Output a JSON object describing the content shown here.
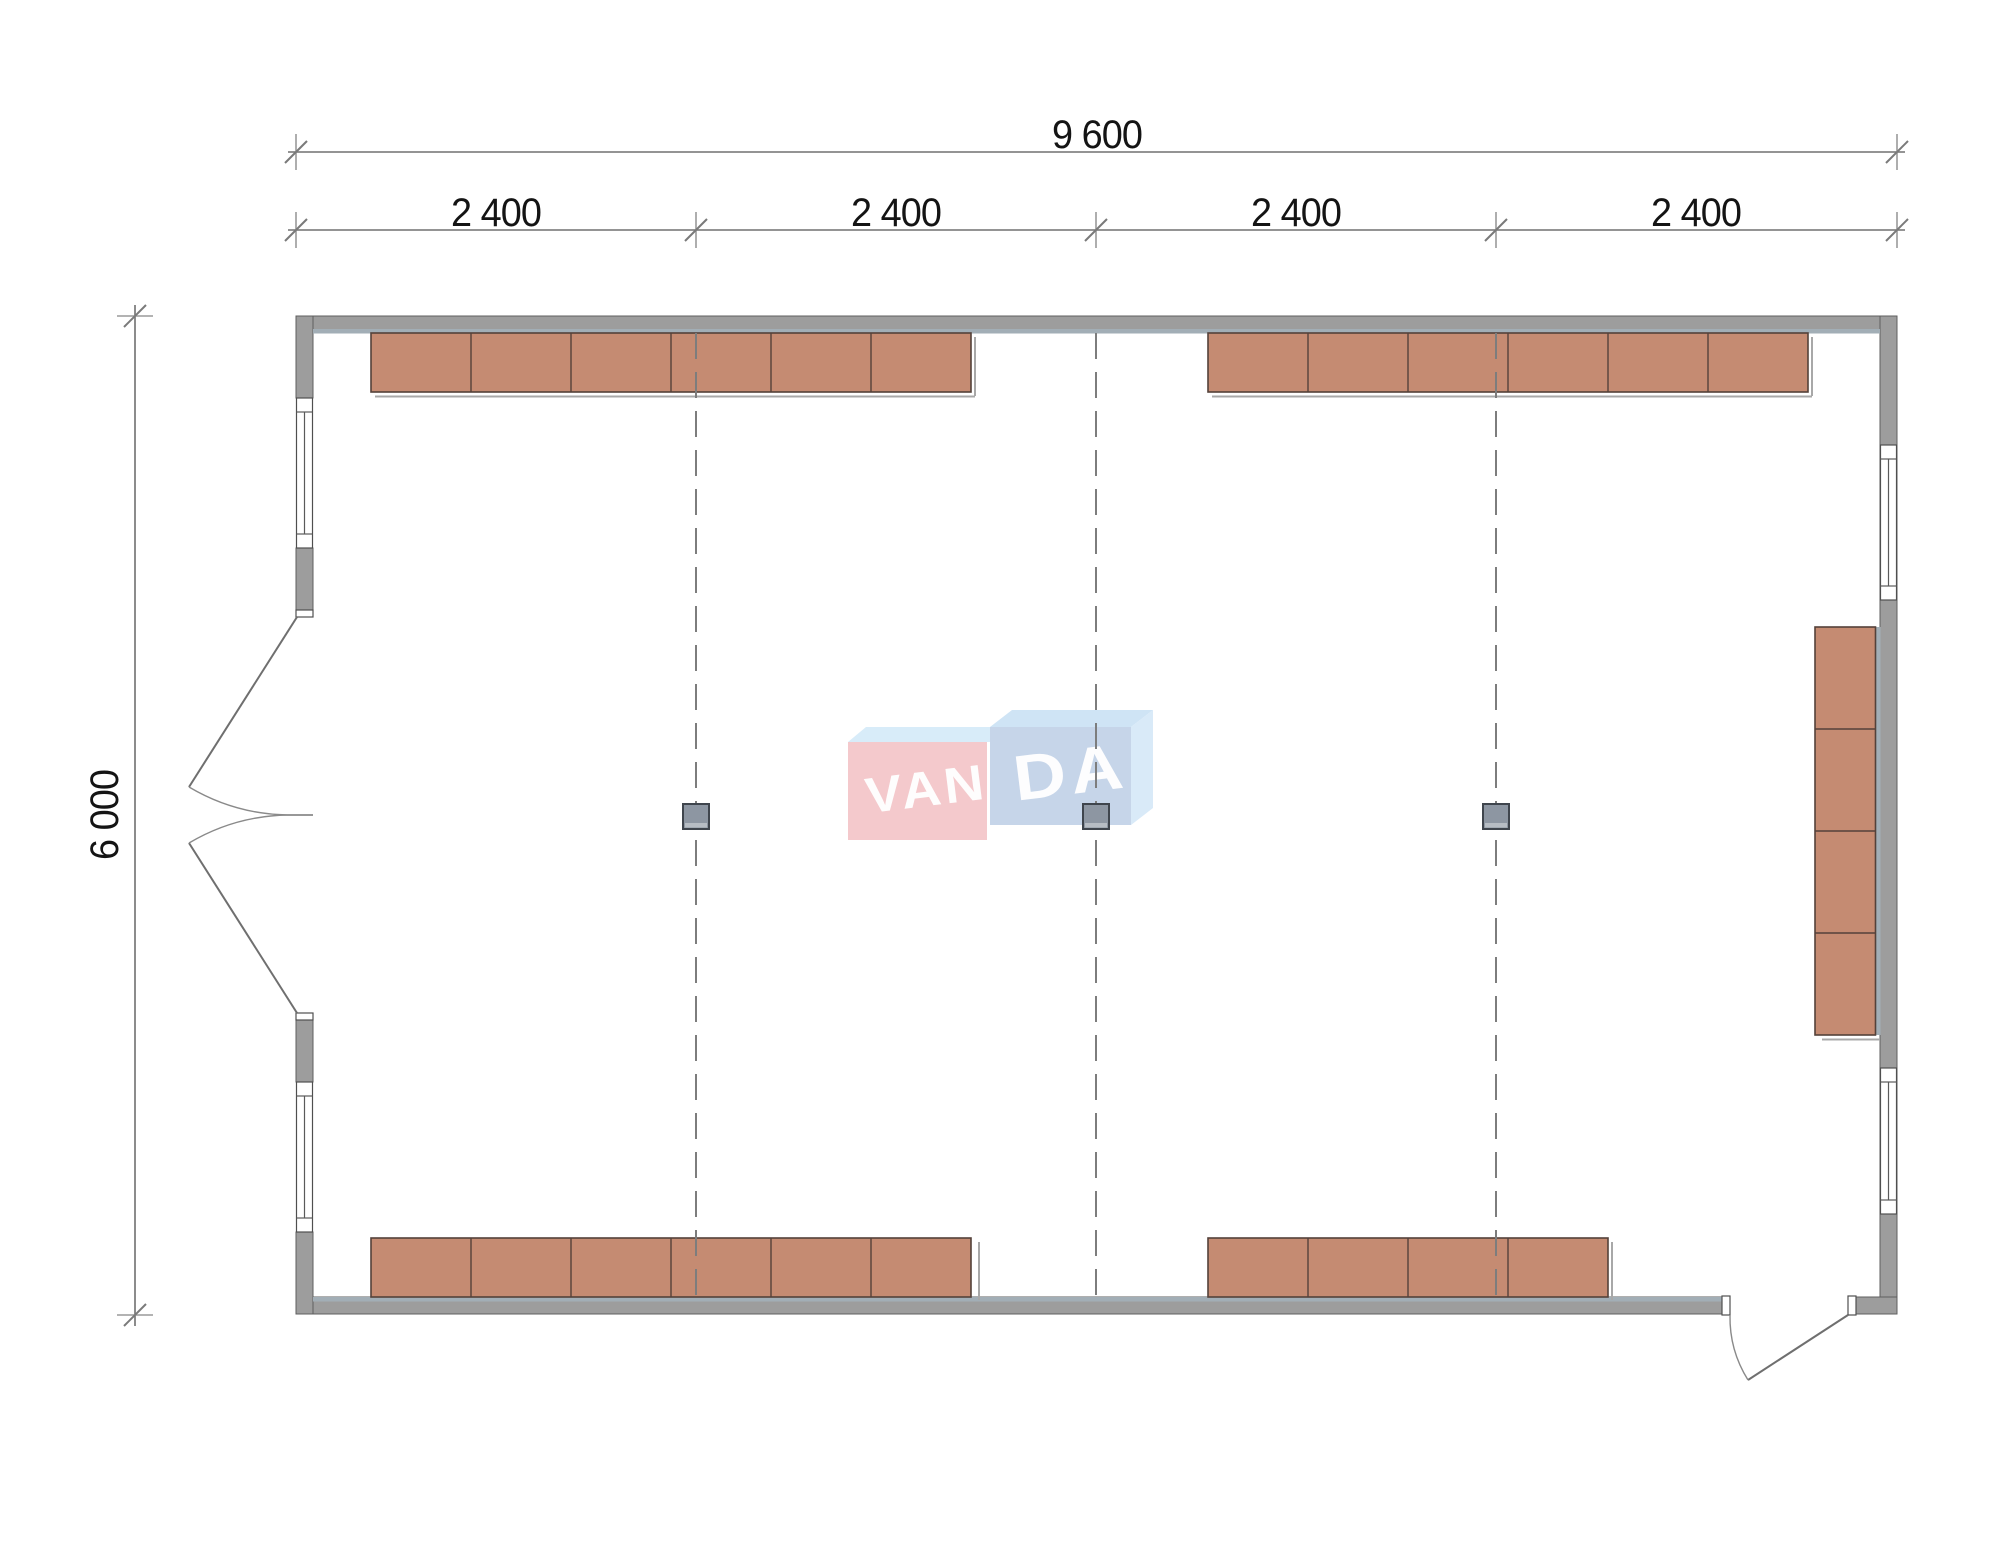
{
  "dimensions": {
    "overall_width": "9 600",
    "bays": [
      "2 400",
      "2 400",
      "2 400",
      "2 400"
    ],
    "overall_depth": "6 000"
  },
  "watermark": {
    "brand": "VANDA",
    "left_word": "VAN",
    "right_word": "DA"
  },
  "furniture": {
    "top_left_desk_units": 6,
    "top_right_desk_units": 6,
    "bottom_left_desk_units": 6,
    "bottom_right_desk_units": 4,
    "right_wall_desk_units": 4,
    "columns": 3
  },
  "colors": {
    "wall": "#9d9d9d",
    "wall_lining": "#a2aeb6",
    "desk": "#c58b72",
    "desk_edge": "#54413a",
    "column_fill": "#8d96a2",
    "column_border": "#3f454d",
    "grid_line": "#7d7d7d",
    "dim_text": "#141414",
    "logo_pink": "#f4c9cc",
    "logo_blue": "#c6d5e9",
    "logo_blue_side": "#d9eaf8",
    "logo_band": "#d8ecf9",
    "logo_top_face": "#cfe4f5"
  }
}
